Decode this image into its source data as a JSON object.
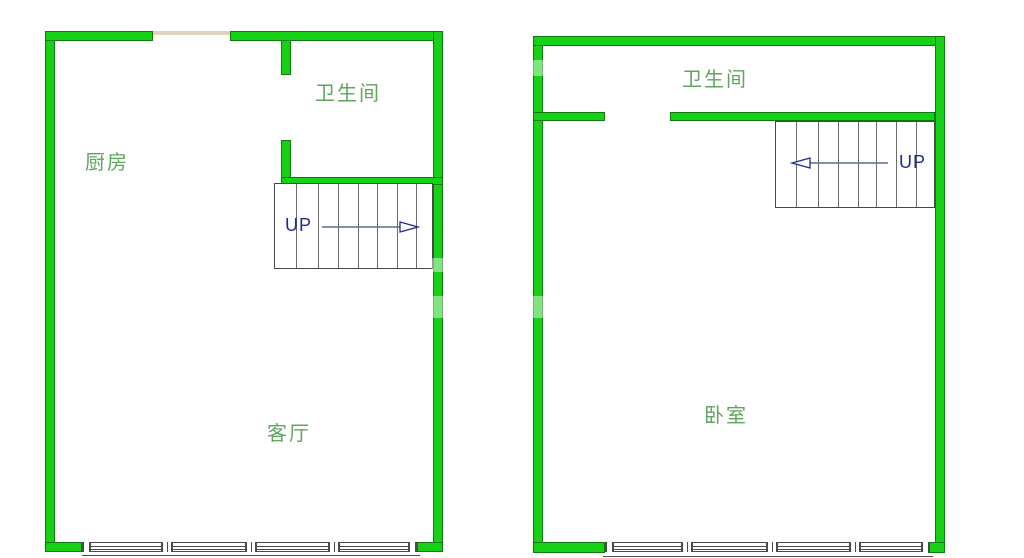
{
  "colors": {
    "background": "#ffffff",
    "wall_fill": "#17d117",
    "wall_edge": "#0e7a0e",
    "room_label": "#5fa55f",
    "stair_border": "#474747",
    "stair_tread": "#6b6b6b",
    "up_text": "#1f2d8f",
    "arrow_line": "#5a6a8f",
    "window_line": "#4a4a4a",
    "door_strip": "#ddd6bd"
  },
  "first_floor": {
    "rooms": {
      "kitchen": "厨房",
      "bathroom": "卫生间",
      "living_room": "客厅"
    },
    "stair_label": "UP"
  },
  "second_floor": {
    "rooms": {
      "bathroom": "卫生间",
      "bedroom": "卧室"
    },
    "stair_label": "UP"
  }
}
